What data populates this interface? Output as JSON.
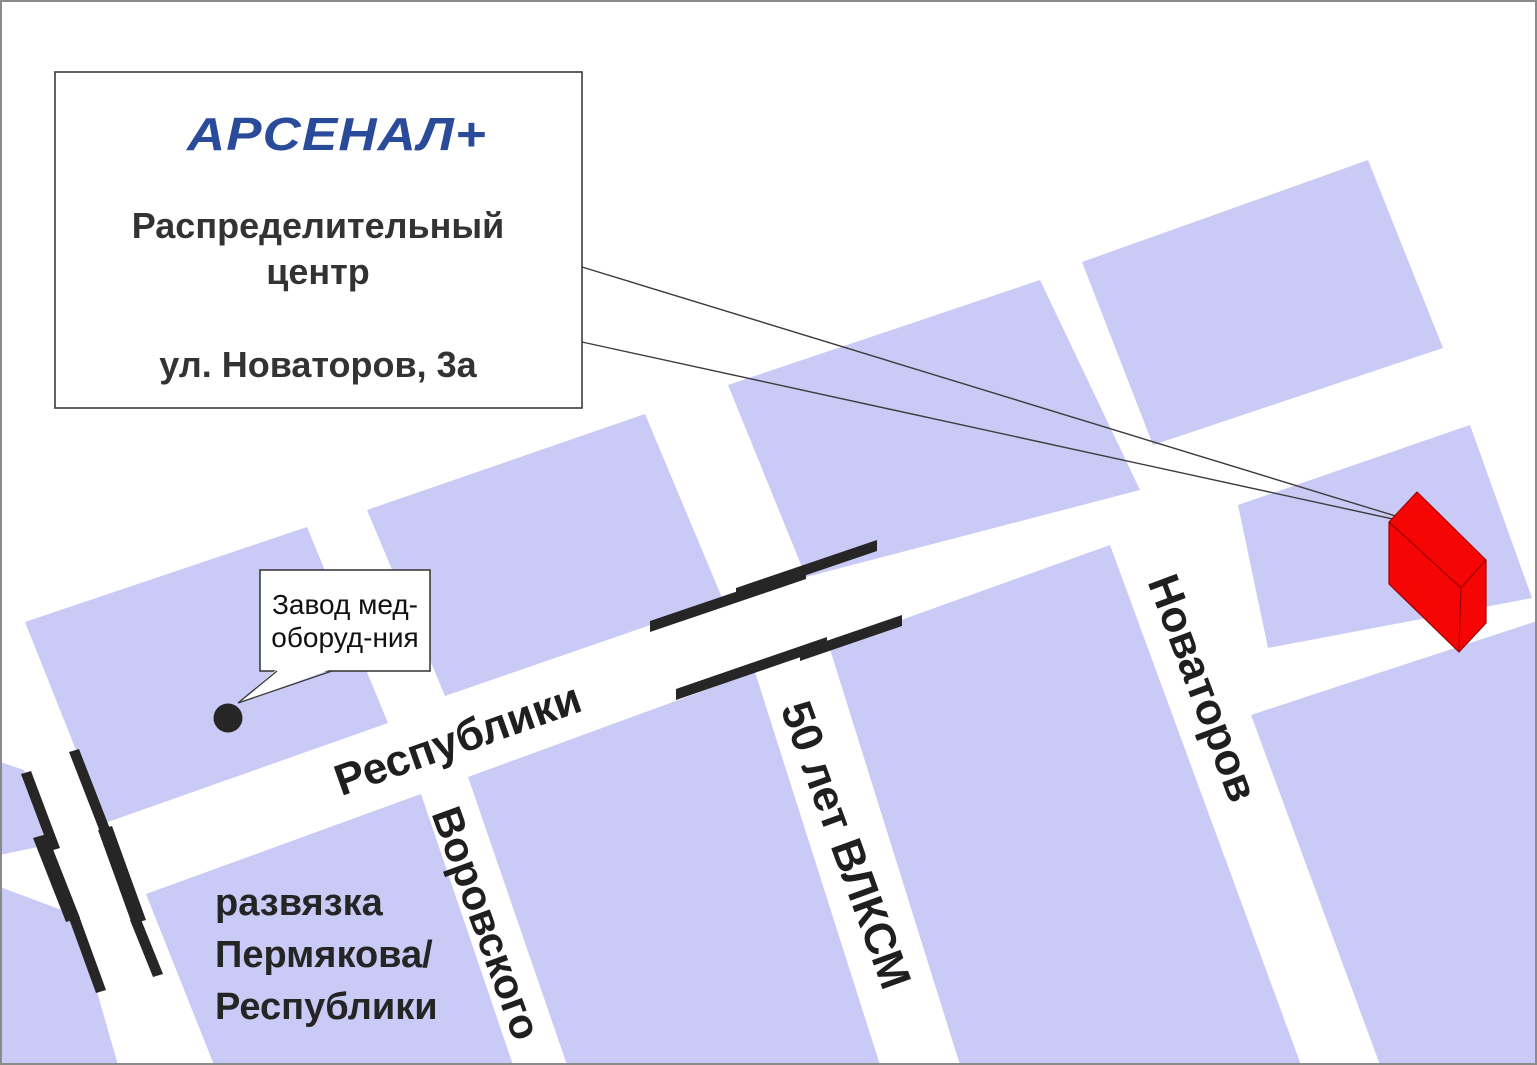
{
  "callout": {
    "logo": "АРСЕНАЛ+",
    "line1": "Распределительный",
    "line2": "центр",
    "address": "ул. Новаторов, 3а"
  },
  "factory": {
    "line1": "Завод мед-",
    "line2": "оборуд-ния"
  },
  "streets": {
    "respubliki": "Республики",
    "vorovskogo": "Воровского",
    "vlksm": "50 лет ВЛКСМ",
    "novatorov": "Новаторов"
  },
  "junction": {
    "line1": "развязка",
    "line2": "Пермякова/",
    "line3": "Республики"
  },
  "colors": {
    "block": "#cacaf6",
    "street": "#ffffff",
    "marker": "#262626",
    "building": "#f60505",
    "logo": "#2a4a9a"
  }
}
